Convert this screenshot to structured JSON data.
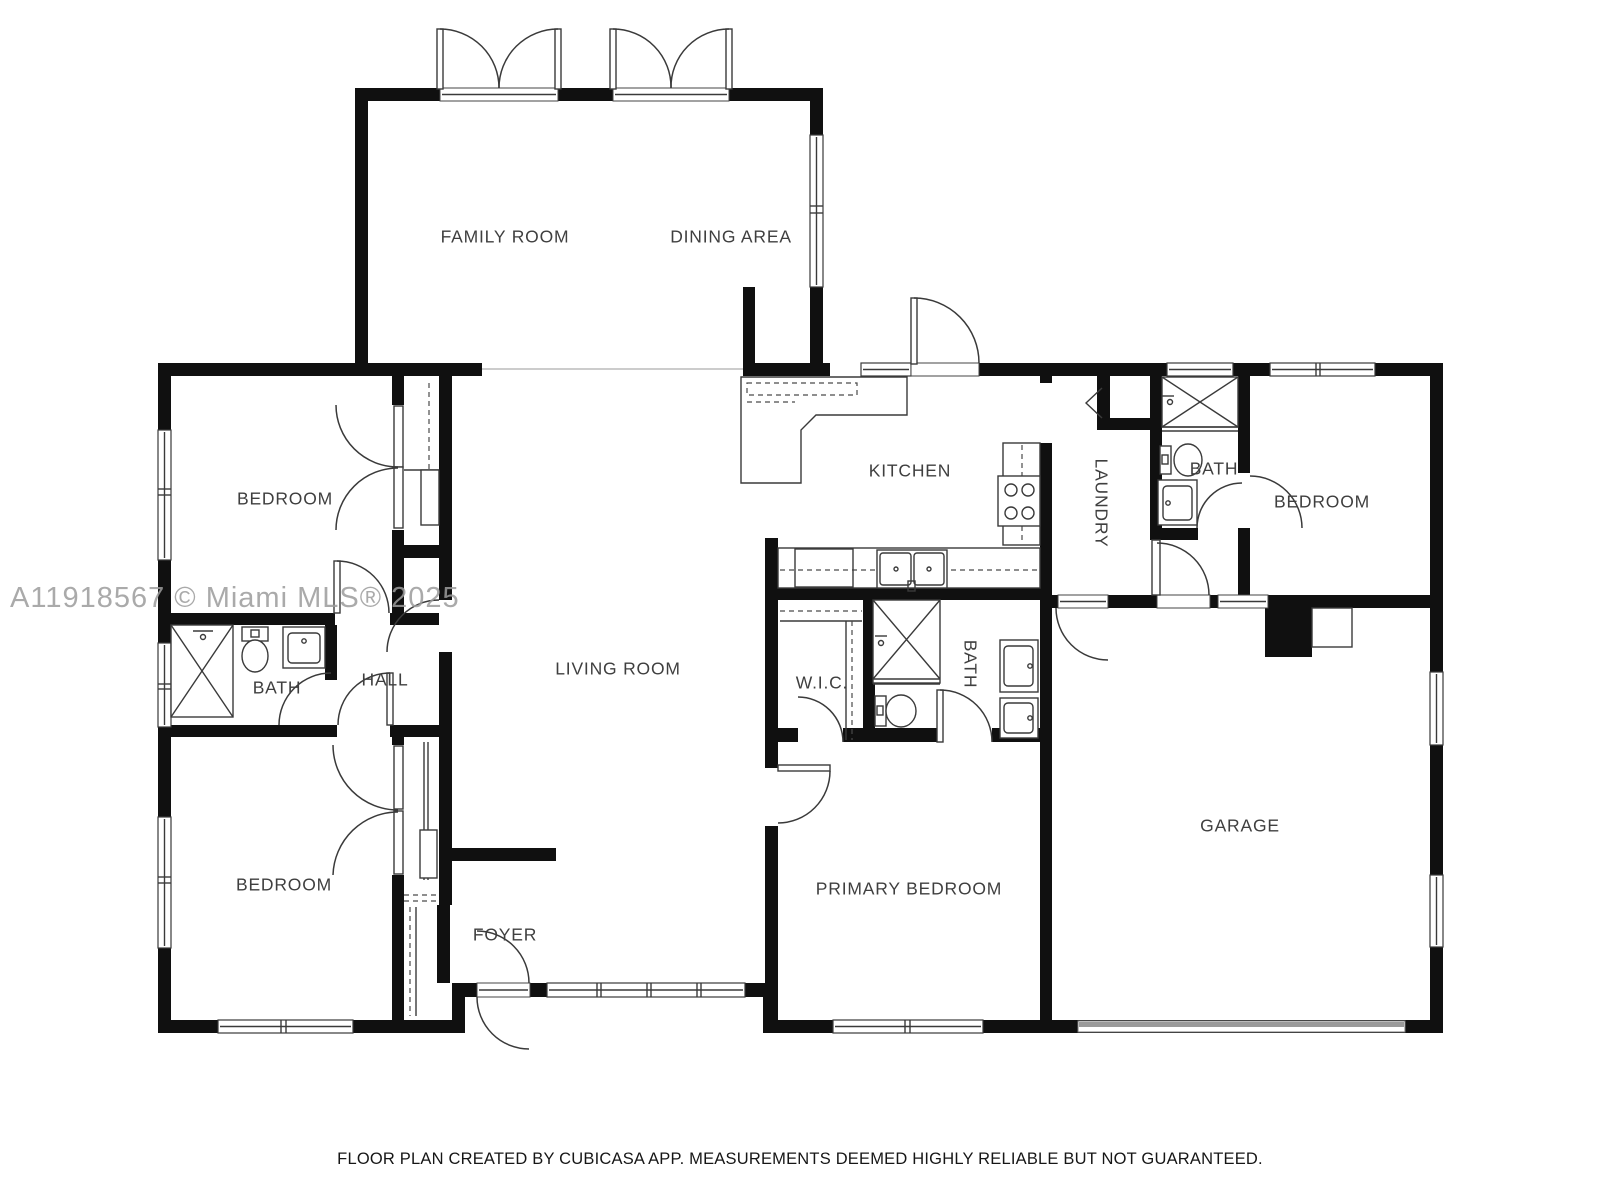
{
  "meta": {
    "type": "floor-plan",
    "creator_note": "FLOOR PLAN CREATED BY CUBICASA APP. MEASUREMENTS DEEMED HIGHLY RELIABLE BUT NOT GUARANTEED."
  },
  "watermark": {
    "text": "A11918567 © Miami MLS® 2025"
  },
  "disclaimer": {
    "text": "FLOOR PLAN CREATED BY CUBICASA APP. MEASUREMENTS DEEMED HIGHLY RELIABLE BUT NOT GUARANTEED."
  },
  "colors": {
    "wall": "#101010",
    "fixture_stroke": "#3a3a3a",
    "label_text": "#3f3f3f",
    "watermark_text": "#9c9c9c",
    "garage_door": "#9a9a9a",
    "background": "#ffffff"
  },
  "rooms": [
    {
      "name": "room-label-family-room",
      "text": "FAMILY ROOM",
      "x": 505,
      "y": 238,
      "rotate": 0
    },
    {
      "name": "room-label-dining-area",
      "text": "DINING AREA",
      "x": 731,
      "y": 238,
      "rotate": 0
    },
    {
      "name": "room-label-bedroom-nw",
      "text": "BEDROOM",
      "x": 285,
      "y": 500,
      "rotate": 0
    },
    {
      "name": "room-label-kitchen",
      "text": "KITCHEN",
      "x": 910,
      "y": 472,
      "rotate": 0
    },
    {
      "name": "room-label-laundry",
      "text": "LAUNDRY",
      "x": 1100,
      "y": 503,
      "rotate": 90
    },
    {
      "name": "room-label-bath-ne",
      "text": "BATH",
      "x": 1214,
      "y": 470,
      "rotate": 0
    },
    {
      "name": "room-label-bedroom-ne",
      "text": "BEDROOM",
      "x": 1322,
      "y": 503,
      "rotate": 0
    },
    {
      "name": "room-label-bath-west",
      "text": "BATH",
      "x": 277,
      "y": 689,
      "rotate": 0
    },
    {
      "name": "room-label-hall",
      "text": "HALL",
      "x": 385,
      "y": 681,
      "rotate": 0
    },
    {
      "name": "room-label-living-room",
      "text": "LIVING ROOM",
      "x": 618,
      "y": 670,
      "rotate": 0
    },
    {
      "name": "room-label-wic",
      "text": "W.I.C.",
      "x": 822,
      "y": 684,
      "rotate": 0
    },
    {
      "name": "room-label-bath-primary",
      "text": "BATH",
      "x": 969,
      "y": 664,
      "rotate": 90
    },
    {
      "name": "room-label-bedroom-sw",
      "text": "BEDROOM",
      "x": 284,
      "y": 886,
      "rotate": 0
    },
    {
      "name": "room-label-foyer",
      "text": "FOYER",
      "x": 505,
      "y": 936,
      "rotate": 0
    },
    {
      "name": "room-label-primary-bedroom",
      "text": "PRIMARY BEDROOM",
      "x": 909,
      "y": 890,
      "rotate": 0
    },
    {
      "name": "room-label-garage",
      "text": "GARAGE",
      "x": 1240,
      "y": 827,
      "rotate": 0
    }
  ]
}
